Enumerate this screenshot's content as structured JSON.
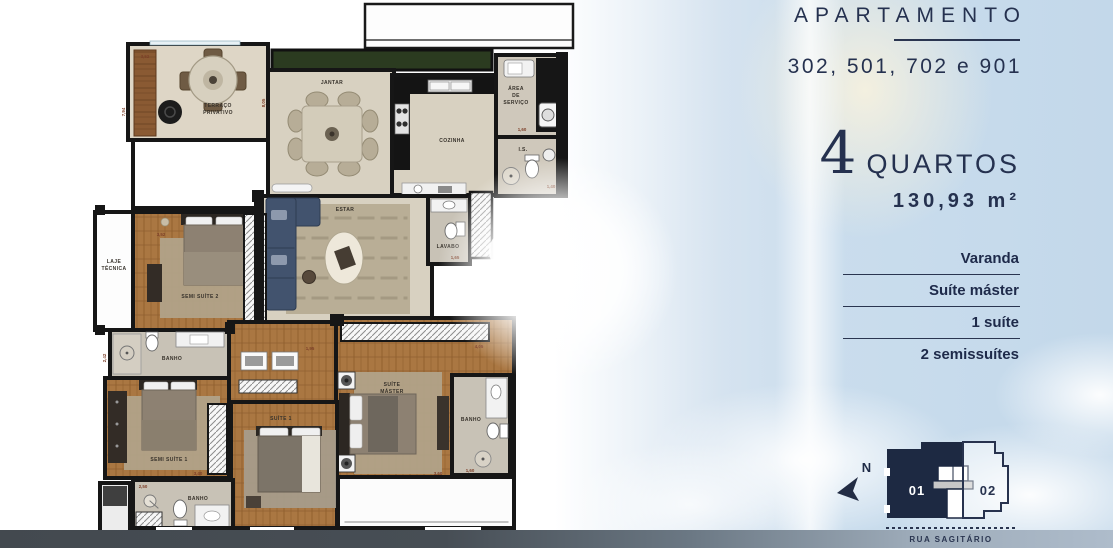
{
  "panel": {
    "title": "APARTAMENTO",
    "units": "302, 501, 702 e 901",
    "rooms_count": "4",
    "rooms_label": "QUARTOS",
    "area": "130,93 m²",
    "features": [
      "Varanda",
      "Suíte máster",
      "1 suíte",
      "2 semissuítes"
    ]
  },
  "floorplan": {
    "rooms": {
      "terraco_l1": "TERRAÇO",
      "terraco_l2": "PRIVATIVO",
      "jantar": "JANTAR",
      "cozinha": "COZINHA",
      "servico_l1": "ÁREA",
      "servico_l2": "DE",
      "servico_l3": "SERVIÇO",
      "is": "I.S.",
      "estar": "ESTAR",
      "lavabo": "LAVABO",
      "laje_l1": "LAJE",
      "laje_l2": "TÉCNICA",
      "semi_suite_2": "SEMI SUÍTE 2",
      "semi_suite_1": "SEMI SUÍTE 1",
      "suite_1": "SUÍTE 1",
      "suite_master_l1": "SUÍTE",
      "suite_master_l2": "MÁSTER",
      "banho": "BANHO"
    },
    "dimensions": {
      "d_805": "8,05",
      "d_794": "7,94",
      "d_352": "3,52",
      "d_242": "2,42",
      "d_340": "3,40",
      "d_250": "2,50",
      "d_290": "2,90",
      "d_195": "1,95",
      "d_260": "2,60",
      "d_165": "1,65",
      "d_160": "1,60",
      "d_140": "1,40",
      "d_360": "3,60",
      "d_405": "4,05"
    }
  },
  "keyplan": {
    "north": "N",
    "unit_01": "01",
    "unit_02": "02",
    "street": "RUA SAGITÁRIO"
  },
  "bottom_bar": {
    "caption": "APARTAMENTOS 302, 501, 702 E 901"
  },
  "colors": {
    "navy": "#25314f",
    "wall": "#161616",
    "wood": "#a9743f",
    "tile": "#d8d1c3",
    "bath_floor": "#c9c3b7",
    "planter_green": "#2b3b20",
    "dim_red": "#7d3f28",
    "sky_blue": "#c3d8ea",
    "unit01_fill": "#1d2942"
  }
}
